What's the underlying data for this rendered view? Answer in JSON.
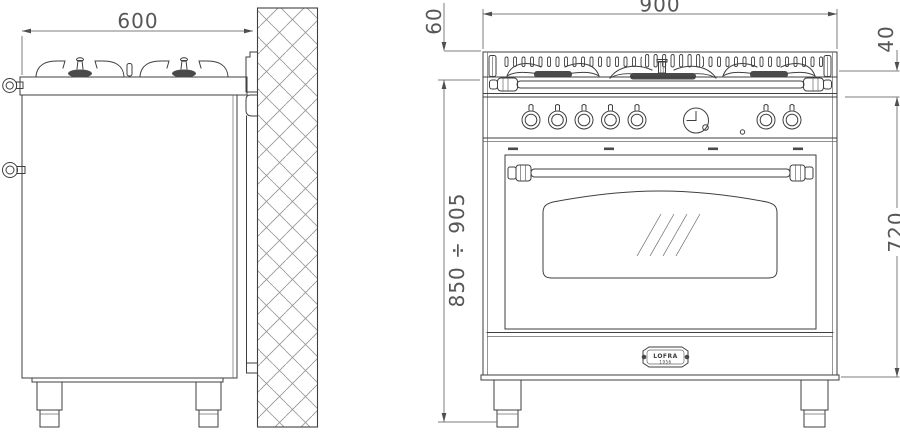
{
  "drawing": {
    "side_view": {
      "width_dim": "600"
    },
    "front_view": {
      "width_dim": "900",
      "hob_top_dim": "60",
      "top_trim_dim": "40",
      "height_range_dim": "850 ÷ 905",
      "body_height_dim": "720",
      "badge": {
        "brand": "LOFRA",
        "year": "1956"
      }
    },
    "colors": {
      "object_line": "#3f3f3f",
      "dimension_line": "#7d7d7d",
      "dimension_text": "#565656",
      "wall_hatch": "#949494",
      "background": "#ffffff"
    }
  }
}
